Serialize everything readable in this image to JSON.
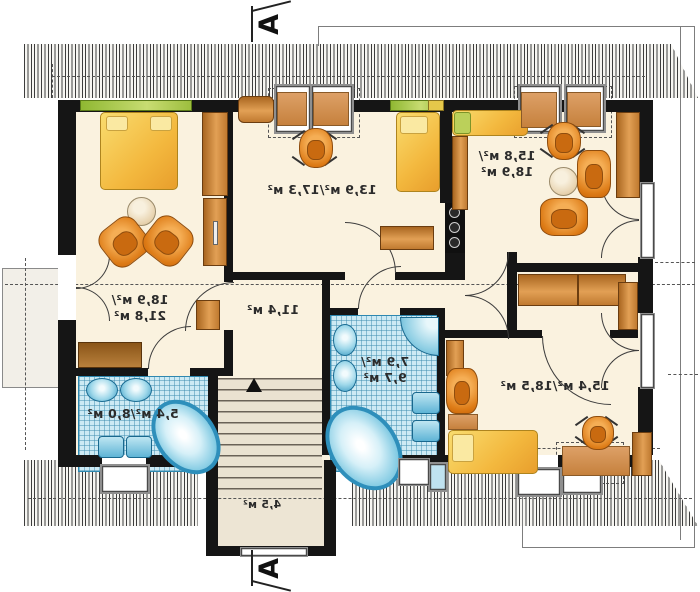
{
  "section_markers": {
    "top": "A",
    "bottom": "A"
  },
  "rooms": {
    "bedroom_left": {
      "area_line1": "18,9 м²/",
      "area_line2": "21,8 м²"
    },
    "room_middle": {
      "area": "13,9 м²/17,3 м²"
    },
    "room_top_right": {
      "area_line1": "15,8 м²/",
      "area_line2": "18,9 м²"
    },
    "bathroom_left": {
      "area": "5,4 м²/8,0 м²"
    },
    "bathroom_middle": {
      "area_line1": "7,9 м²/",
      "area_line2": "9,7 м²"
    },
    "hall": {
      "area": "11,4 м²"
    },
    "room_bottom_right": {
      "area": "15,4 м²/18,5 м²"
    },
    "staircase": {
      "area": "4,5 м²"
    }
  },
  "colors": {
    "floor": "#FAF2DF",
    "wall": "#151515",
    "bath_tile": "#CDEAF4",
    "fixture_blue": "#5FB4D6",
    "furniture_orange": "#E8882B",
    "wood_brown": "#C07A32",
    "bed_yellow": "#F5C23E",
    "window_green": "#9DBE3E"
  }
}
